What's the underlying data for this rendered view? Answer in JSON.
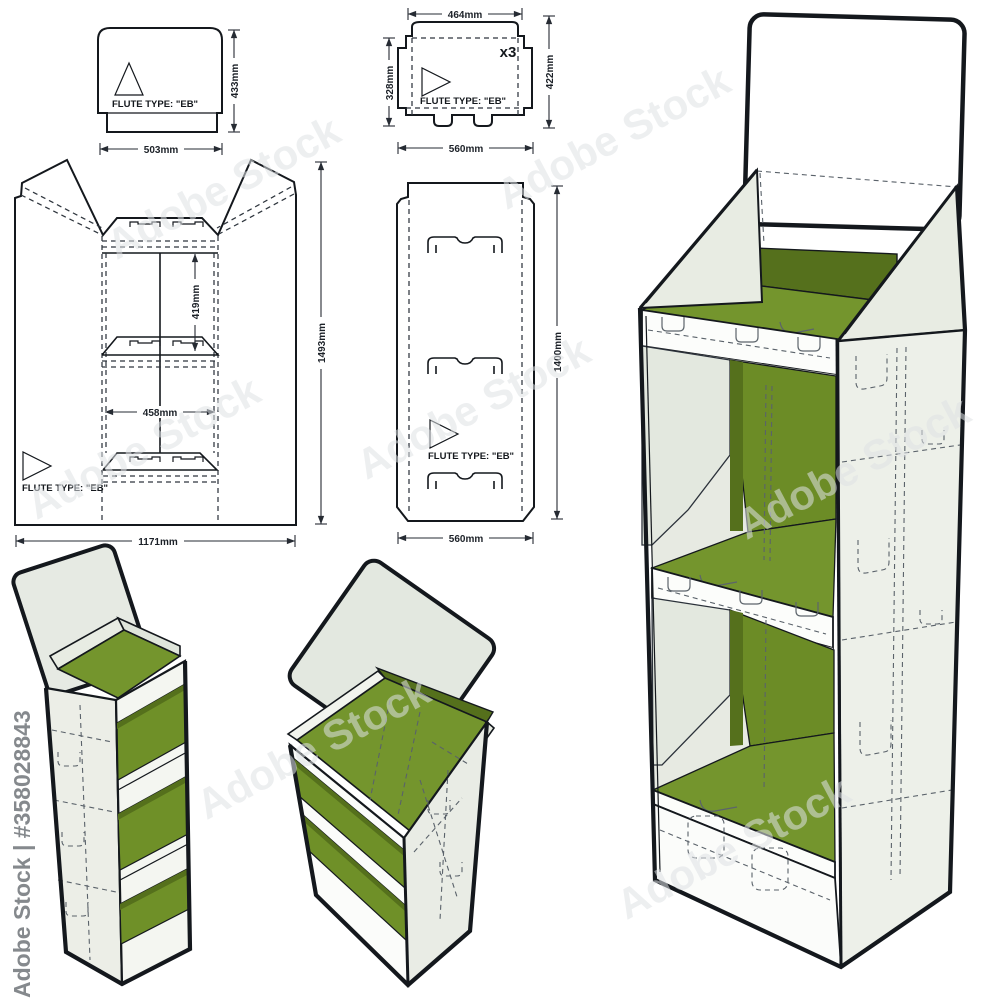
{
  "flute_label": "FLUTE TYPE: \"EB\"",
  "pieces": {
    "header_panel": {
      "width": "503mm",
      "height": "433mm"
    },
    "shelf_tray": {
      "top_width": "464mm",
      "left_height": "328mm",
      "right_height": "422mm",
      "bottom_width": "560mm",
      "quantity": "x3"
    },
    "main_body": {
      "shelf_spacing": "419mm",
      "shelf_width": "458mm",
      "total_width": "1171mm",
      "total_height": "1493mm"
    },
    "side_panel": {
      "height": "1400mm",
      "width": "560mm"
    }
  },
  "watermarks": {
    "stock_id_label": "Adobe Stock | #358028843",
    "diagonal_text": "Adobe Stock"
  },
  "colors": {
    "shelf_green": "#74952d",
    "shelf_green_mid": "#6c8c26",
    "shelf_green_dark": "#55701c",
    "panel_light": "#e8ece3",
    "panel_lighter": "#f2f4ee",
    "line_dark": "#14181d"
  }
}
